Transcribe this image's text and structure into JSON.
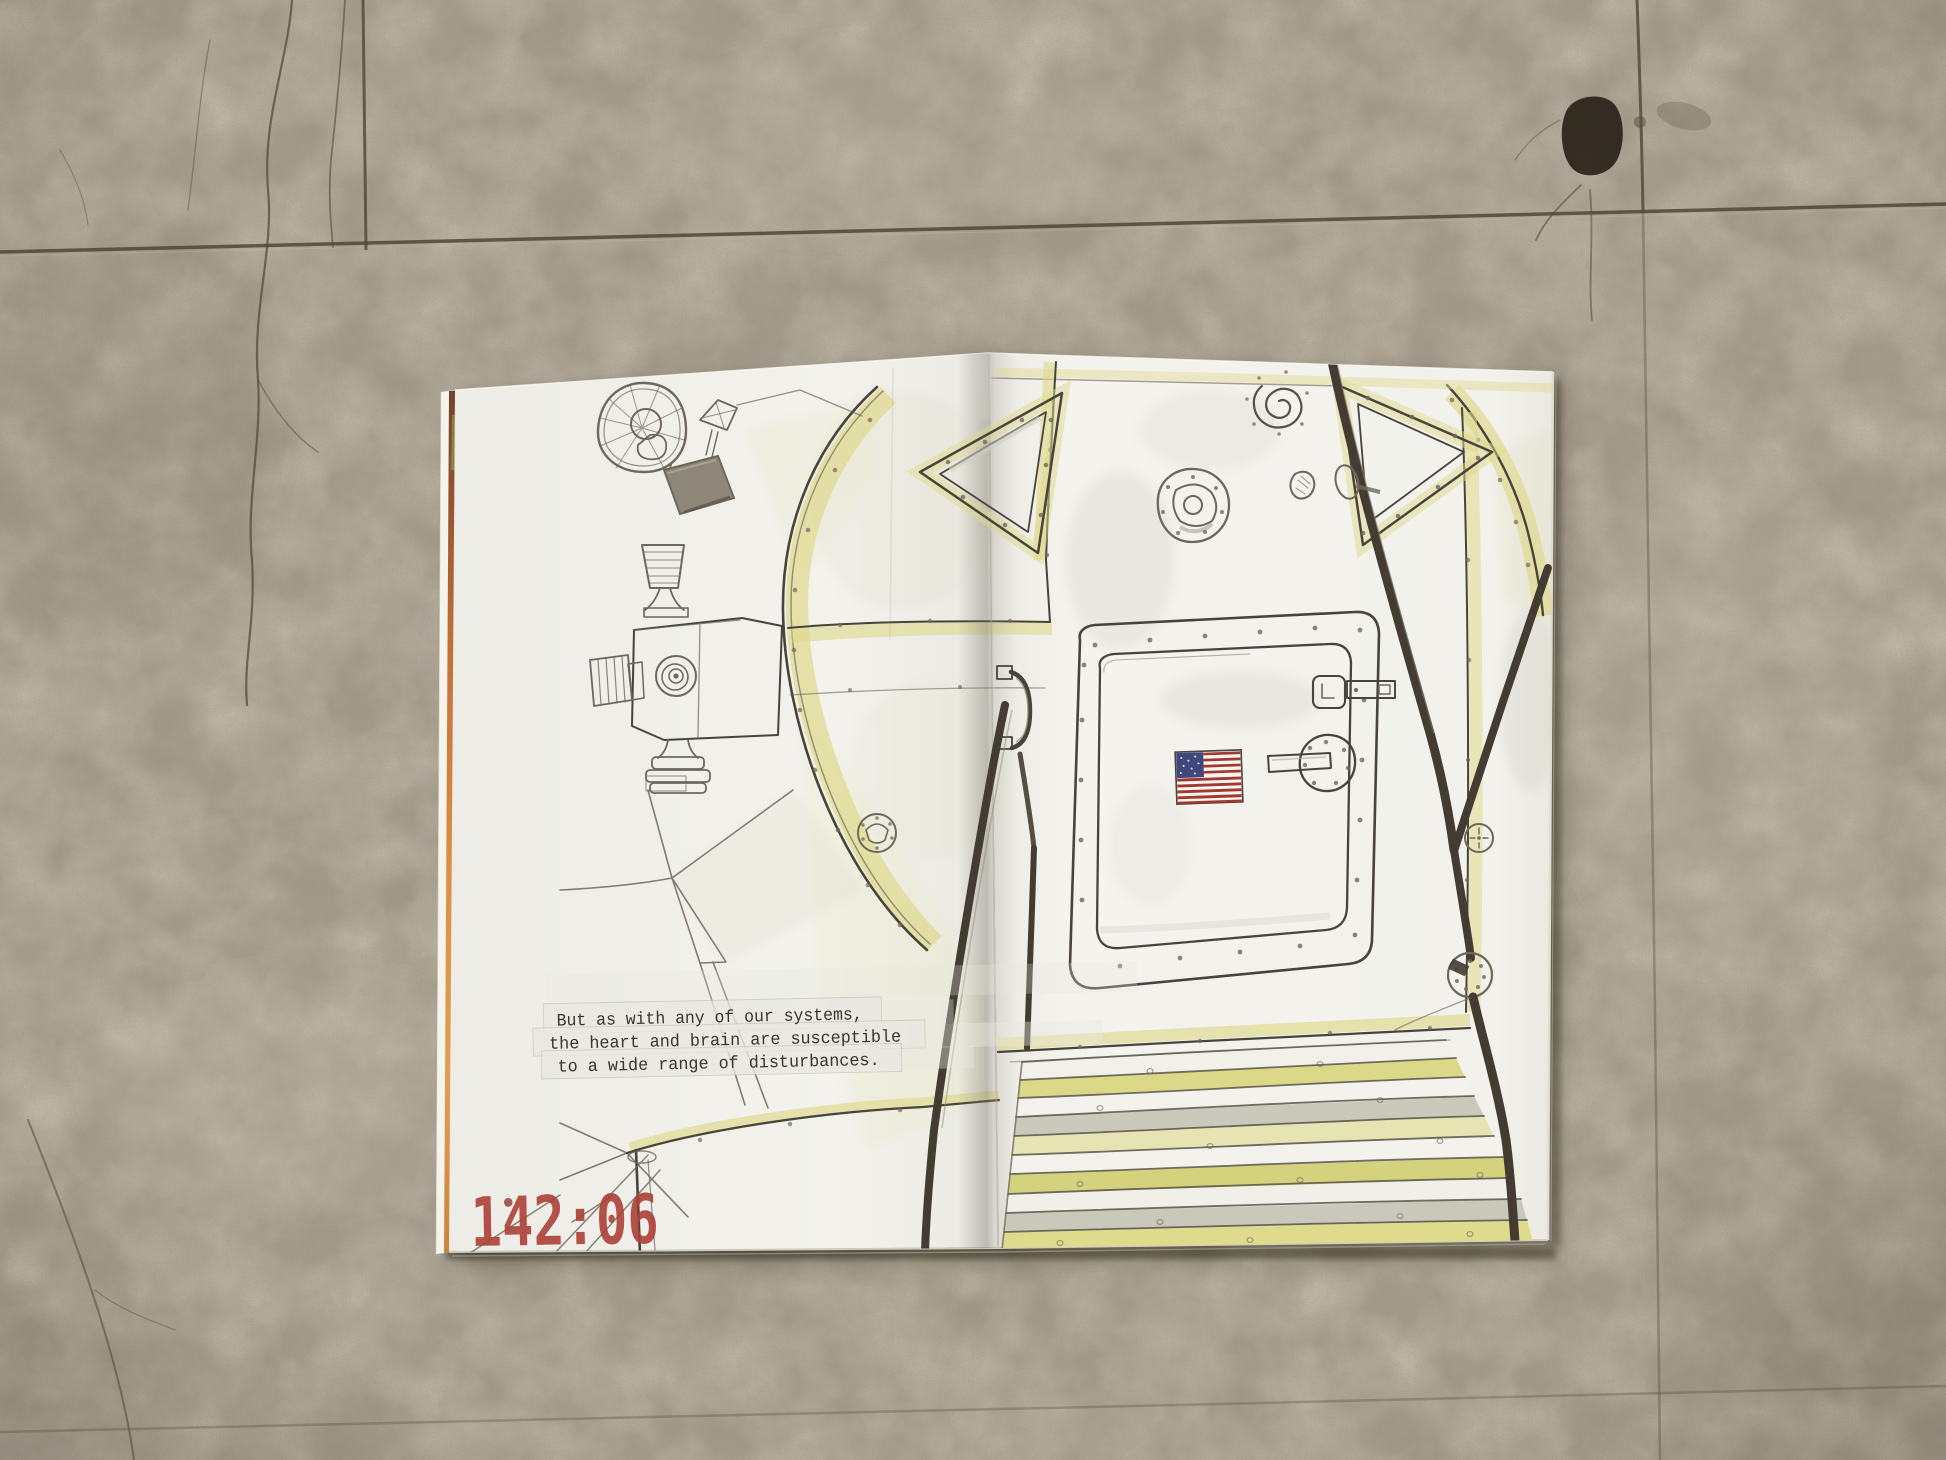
{
  "zine": {
    "caption_lines": [
      "But as with any of our systems,",
      "the heart and brain are susceptible",
      "to a wide range of disturbances."
    ],
    "mission_time": "142:06"
  },
  "colors": {
    "floor": "#a69d8d",
    "floor_seam": "#4f4637",
    "paper": "#f2f1ec",
    "wash_yellow": "#ded98b",
    "wash_gray": "#d7d5cc",
    "pencil": "#6e675c",
    "ink": "#49443b",
    "rail_dark": "#423c33",
    "stamp_red": "#ac4037",
    "flag_blue": "#3f477f",
    "flag_red": "#a23931",
    "edge_orange": "#d07a33"
  },
  "elements": {
    "left_page": [
      "dish-antenna-sketch",
      "tv-camera-sketch",
      "ascent-stage-rim",
      "descent-stage-facets",
      "vent-port",
      "landing-leg-sketch",
      "caption-tape",
      "mission-time-stamp"
    ],
    "right_page": [
      "triangular-window-left",
      "triangular-window-right",
      "spiral-doodle",
      "docking-drum",
      "hatch-door",
      "us-flag",
      "door-handle",
      "door-latch",
      "grab-handle",
      "handrail-left",
      "handrail-right",
      "bolt-plate",
      "porch-steps"
    ]
  }
}
